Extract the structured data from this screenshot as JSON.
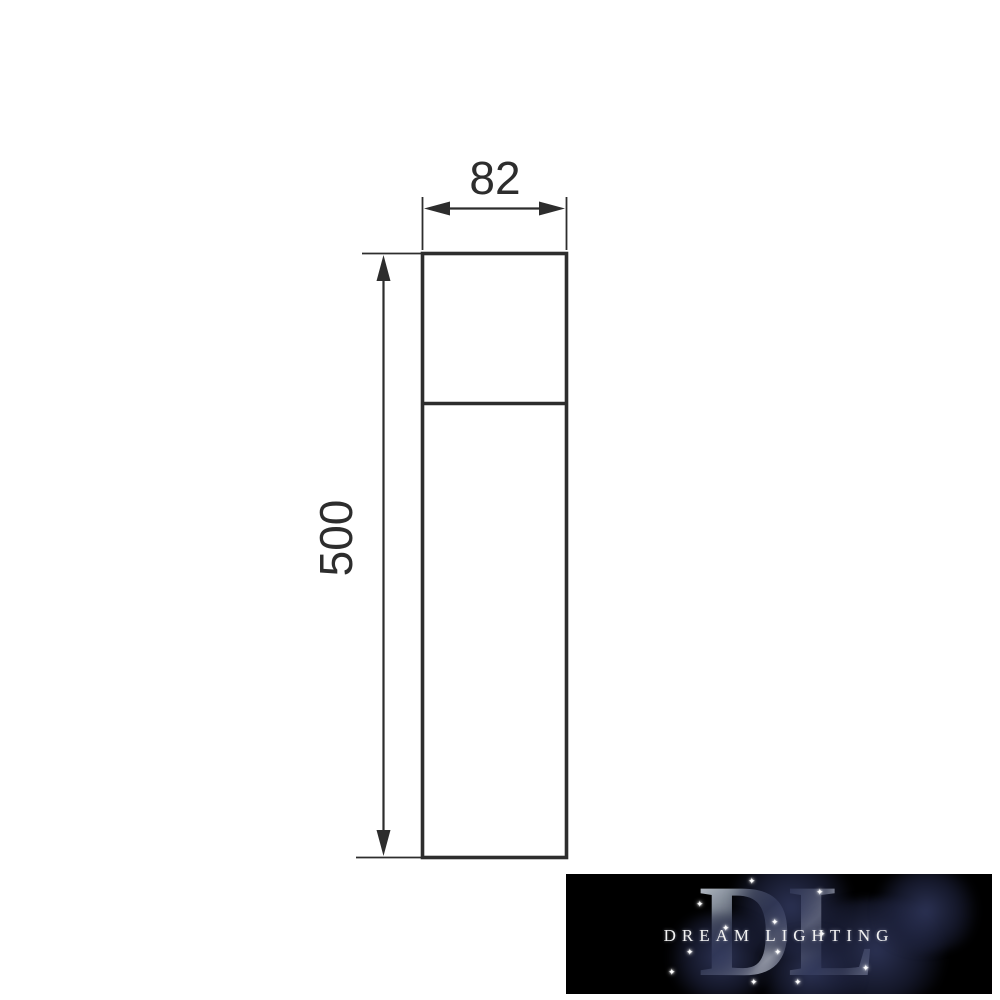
{
  "drawing": {
    "width_label": "82",
    "height_label": "500",
    "line_color": "#2d2d2d"
  },
  "watermark": {
    "monogram": "DL",
    "brand_text": "DREAM LIGHTING",
    "background_color": "#000000",
    "smoke_color": "#202542",
    "monogram_metal_colors": [
      "#eef1f5",
      "#9aa3af",
      "#454c5c",
      "#dfe3e8",
      "#596172",
      "#cfd5dc"
    ],
    "sparkle_glyph": "✦"
  }
}
